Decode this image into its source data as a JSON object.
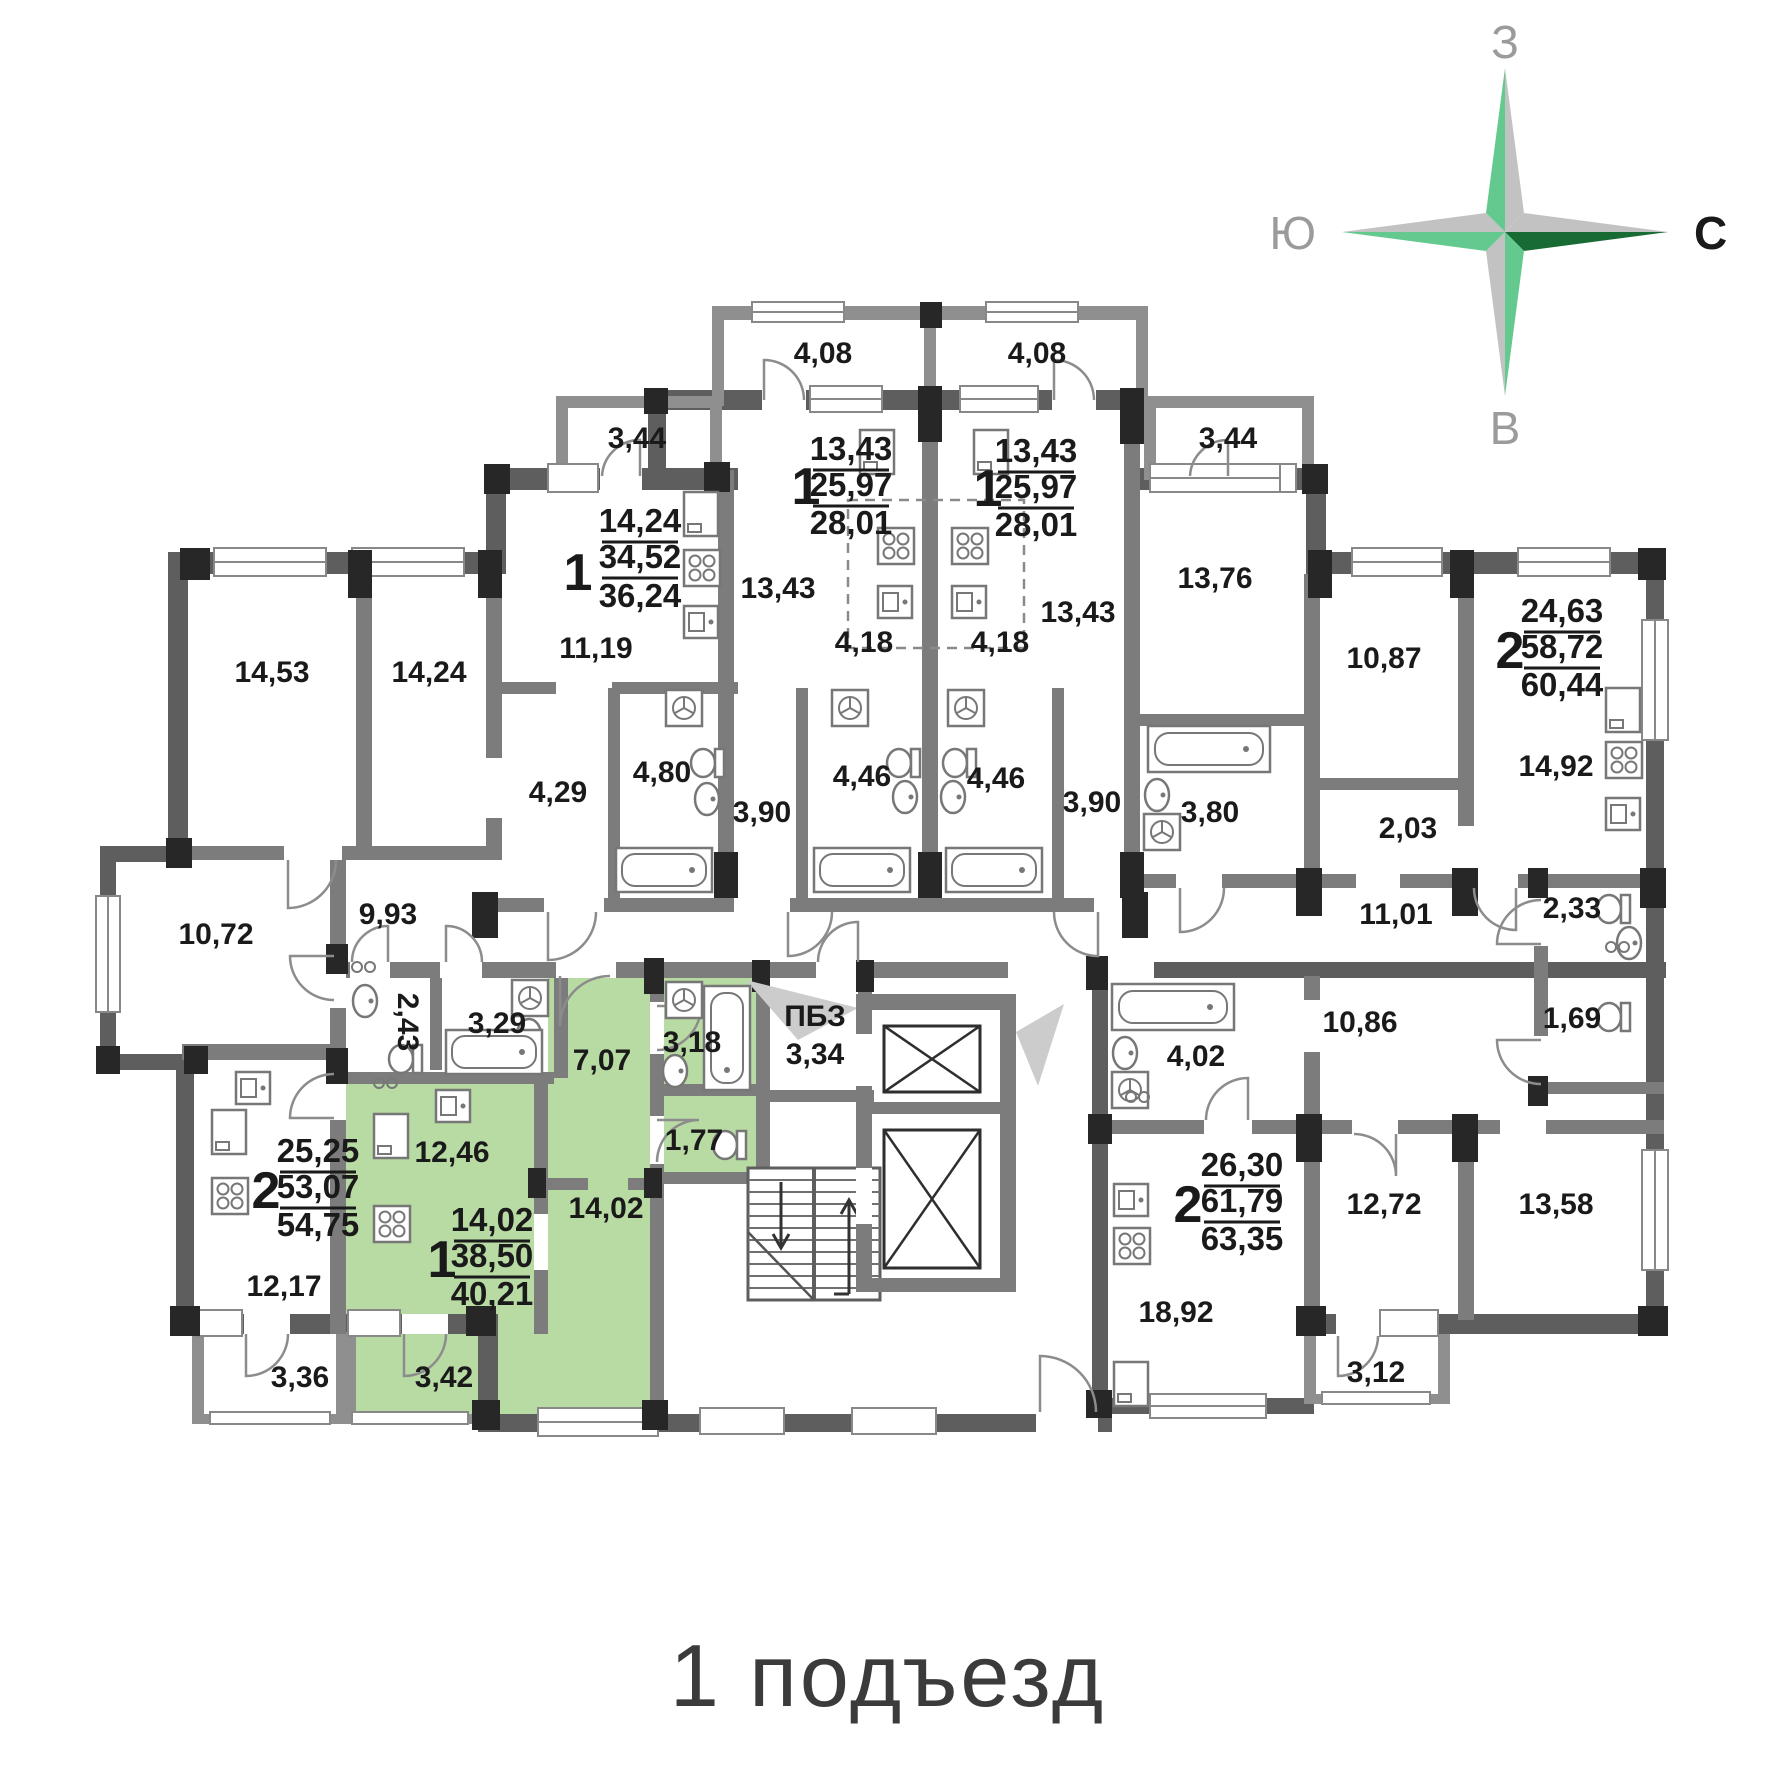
{
  "title": "1 подъезд",
  "compass": {
    "n": "С",
    "e": "В",
    "s": "Ю",
    "w": "З"
  },
  "core": {
    "pbz_label": "ПБЗ",
    "pbz_area": "3,34"
  },
  "apartments": [
    {
      "id": "A",
      "num": "1",
      "living": "14,24",
      "area": "34,52",
      "total": "36,24"
    },
    {
      "id": "B",
      "num": "1",
      "living": "13,43",
      "area": "25,97",
      "total": "28,01"
    },
    {
      "id": "C",
      "num": "1",
      "living": "13,43",
      "area": "25,97",
      "total": "28,01"
    },
    {
      "id": "D",
      "num": "2",
      "living": "24,63",
      "area": "58,72",
      "total": "60,44"
    },
    {
      "id": "E",
      "num": "2",
      "living": "25,25",
      "area": "53,07",
      "total": "54,75"
    },
    {
      "id": "F",
      "num": "1",
      "living": "14,02",
      "area": "38,50",
      "total": "40,21",
      "highlighted": true
    },
    {
      "id": "G",
      "num": "2",
      "living": "26,30",
      "area": "61,79",
      "total": "63,35"
    }
  ],
  "rooms": {
    "balc_408_l": "4,08",
    "balc_408_r": "4,08",
    "balc_344_l": "3,44",
    "balc_344_r": "3,44",
    "r_1453": "14,53",
    "r_1424": "14,24",
    "r_1119": "11,19",
    "r_1343_l": "13,43",
    "r_1343_r": "13,43",
    "k_418_l": "4,18",
    "k_418_r": "4,18",
    "r_1376": "13,76",
    "r_1087": "10,87",
    "k_1492": "14,92",
    "c_203": "2,03",
    "h_1101": "11,01",
    "wc_233": "2,33",
    "wc_169": "1,69",
    "h_1086": "10,86",
    "b_402": "4,02",
    "r_1272": "12,72",
    "r_1358": "13,58",
    "k_1892": "18,92",
    "balc_312": "3,12",
    "r_1072": "10,72",
    "h_993": "9,93",
    "h_429": "4,29",
    "b_480": "4,80",
    "h_390_l": "3,90",
    "b_446_l": "4,46",
    "b_446_r": "4,46",
    "h_390_r": "3,90",
    "b_380": "3,80",
    "wc_243": "2,43",
    "b_329": "3,29",
    "k_1217": "12,17",
    "balc_336": "3,36",
    "k_1246": "12,46",
    "h_707": "7,07",
    "b_318": "3,18",
    "wc_177": "1,77",
    "r_1402": "14,02",
    "balc_342": "3,42"
  },
  "colors": {
    "highlight": "#b8dba4",
    "wall_dark": "#5e5e5e",
    "wall_mid": "#7c7c7c",
    "pier": "#272727",
    "compass_green": "#63c98e",
    "compass_dark_green": "#176b33",
    "compass_gray": "#c2c2c2"
  }
}
